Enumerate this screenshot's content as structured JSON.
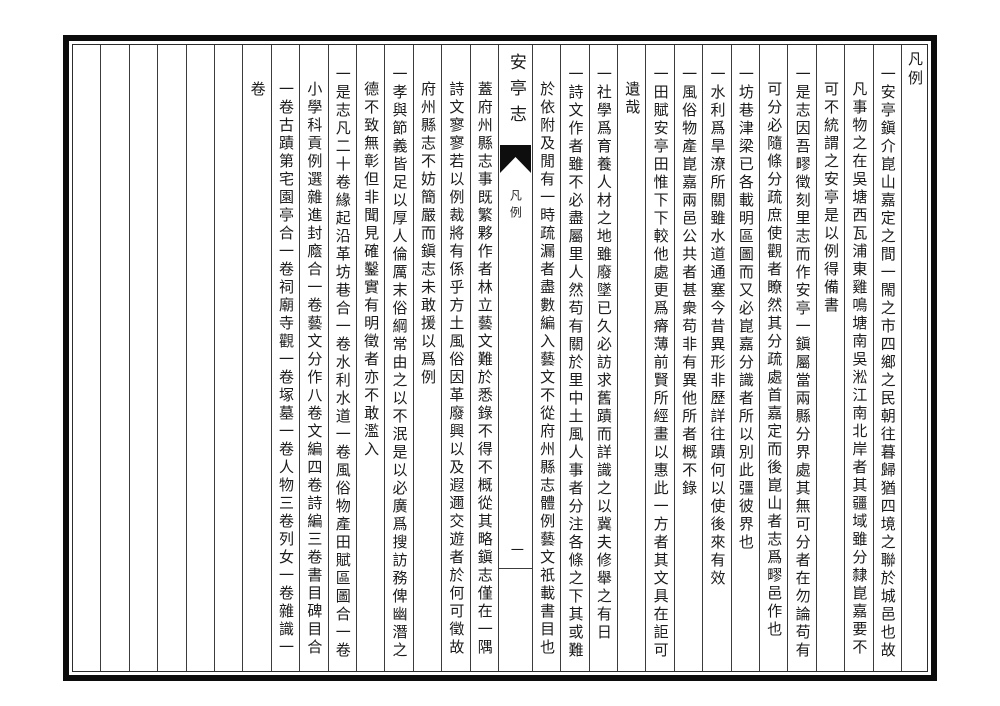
{
  "ink": "#1b1b1b",
  "paper": "#ffffff",
  "header": {
    "section_label": "凡例"
  },
  "banxin": {
    "title": "安亭志",
    "section_label": "凡例",
    "page_number": "一",
    "fishtail_icon": "black-fishtail-mark"
  },
  "columns": [
    "一安亭鎭介崑山嘉定之間一閙之市四鄉之民朝往暮歸猶四境之聯於城邑也故",
    "凡事物之在吳塘西瓦浦東雞鳴塘南吳淞江南北岸者其疆域雖分隸崑嘉要不",
    "可不統謂之安亭是以例得備書",
    "一是志因吾疁徵刻里志而作安亭一鎭屬當兩縣分界處其無可分者在勿論苟有",
    "可分必隨條分疏庶使觀者瞭然其分疏處首嘉定而後崑山者志爲疁邑作也",
    "一坊巷津梁已各載明區圖而又必崑嘉分識者所以別此彊彼界也",
    "一水利爲旱潦所關雖水道通塞今昔異形非歷詳往蹟何以使後來有效",
    "一風俗物產崑嘉兩邑公共者甚衆苟非有異他所者概不錄",
    "一田賦安亭田惟下下較他處更爲瘠薄前賢所經畫以惠此一方者其文具在詎可",
    "遺哉",
    "一社學爲育養人材之地雖廢墜已久必訪求舊蹟而詳識之以冀夫修舉之有日",
    "一詩文作者雖不必盡屬里人然苟有關於里中土風人事者分注各條之下其或難",
    "於依附及閒有一時疏漏者盡數編入藝文不從府州縣志體例藝文祇載書目也",
    "蓋府州縣志事既繁夥作者林立藝文難於悉錄不得不概從其略鎭志僅在一隅",
    "詩文寥寥若以例裁將有係乎方土風俗因革廢興以及遐邇交遊者於何可徵故",
    "府州縣志不妨簡嚴而鎭志未敢援以爲例",
    "一孝與節義皆足以厚人倫厲末俗綱常由之以不泯是以必廣爲搜訪務俾幽潛之",
    "德不致無彰但非聞見確鑿實有明徵者亦不敢濫入",
    "一是志凡二十卷緣起沿革坊巷合一卷水利水道一卷風俗物產田賦區圖合一卷",
    "小學科貢例選雜進封廕合一卷藝文分作八卷文編四卷詩編三卷書目碑目合",
    "一卷古蹟第宅園亭合一卷祠廟寺觀一卷塚墓一卷人物三卷列女一卷雜識一",
    "卷"
  ]
}
